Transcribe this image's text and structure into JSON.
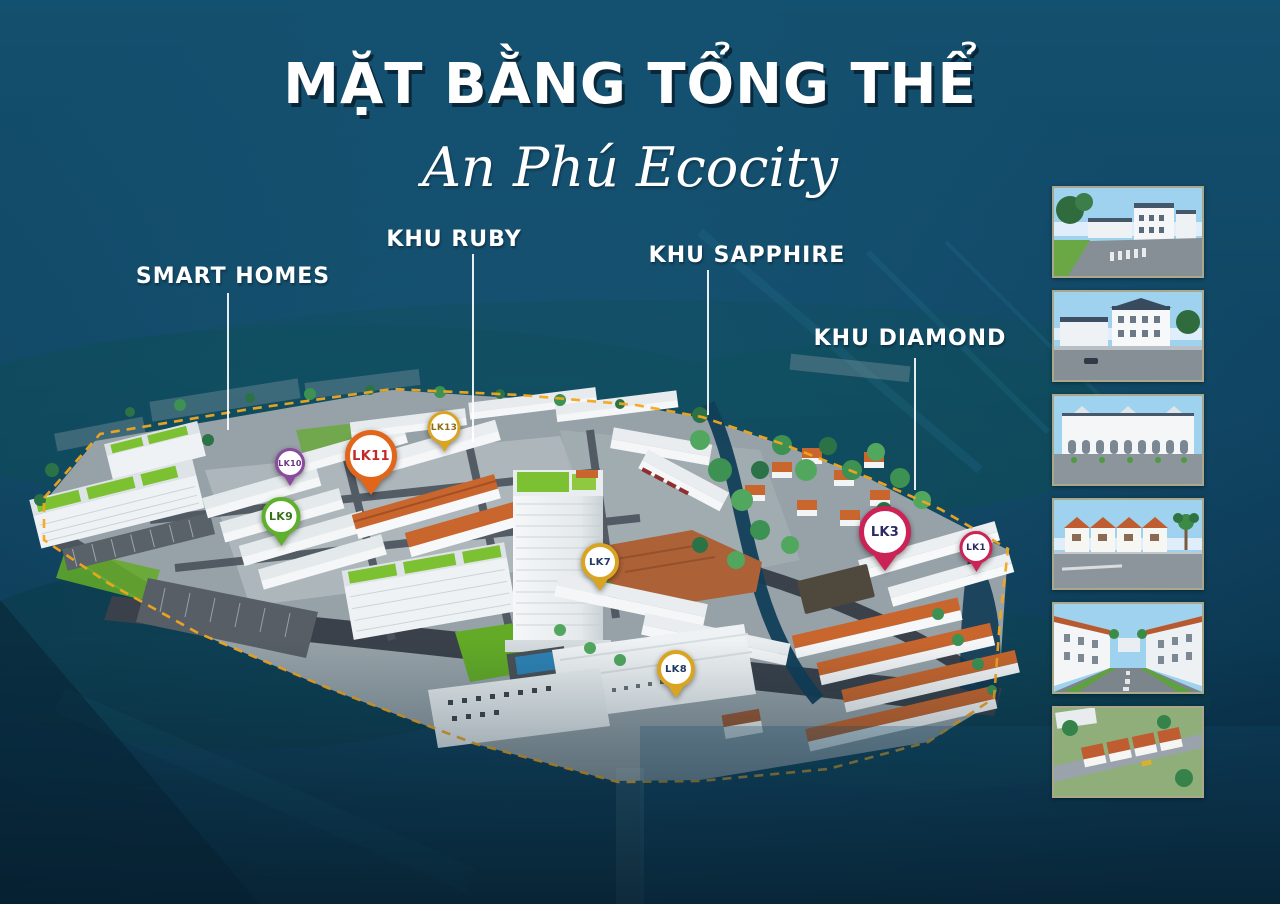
{
  "poster": {
    "title": "MẶT BẰNG TỔNG THỂ",
    "subtitle": "An Phú Ecocity",
    "background_color": "#0f4462",
    "boundary_dash_color": "#f2a71c",
    "zone_label_color": "#ffffff",
    "thumbnail_border_color": "#aaa88a"
  },
  "zones": [
    {
      "label": "SMART HOMES"
    },
    {
      "label": "KHU RUBY"
    },
    {
      "label": "KHU SAPPHIRE"
    },
    {
      "label": "KHU DIAMOND"
    }
  ],
  "pins": [
    {
      "label": "LK10",
      "color": "#8a4a9e",
      "text_color": "#6a3388"
    },
    {
      "label": "LK11",
      "color": "#e2651c",
      "text_color": "#c22a2a"
    },
    {
      "label": "LK13",
      "color": "#d9a521",
      "text_color": "#8a6d15"
    },
    {
      "label": "LK9",
      "color": "#5fb02c",
      "text_color": "#35701c"
    },
    {
      "label": "LK7",
      "color": "#d9a521",
      "text_color": "#1d3a63"
    },
    {
      "label": "LK8",
      "color": "#d9a521",
      "text_color": "#1d3a63"
    },
    {
      "label": "LK3",
      "color": "#cb2356",
      "text_color": "#2c2a66"
    },
    {
      "label": "LK1",
      "color": "#cb2356",
      "text_color": "#2c2a66"
    }
  ],
  "thumbnails": [
    {
      "name": "render-white-townhouse-street"
    },
    {
      "name": "render-white-townhouse-corner"
    },
    {
      "name": "render-white-shophouse-row"
    },
    {
      "name": "render-terracotta-villa-row"
    },
    {
      "name": "render-villa-boulevard"
    },
    {
      "name": "render-terracotta-aerial"
    }
  ]
}
